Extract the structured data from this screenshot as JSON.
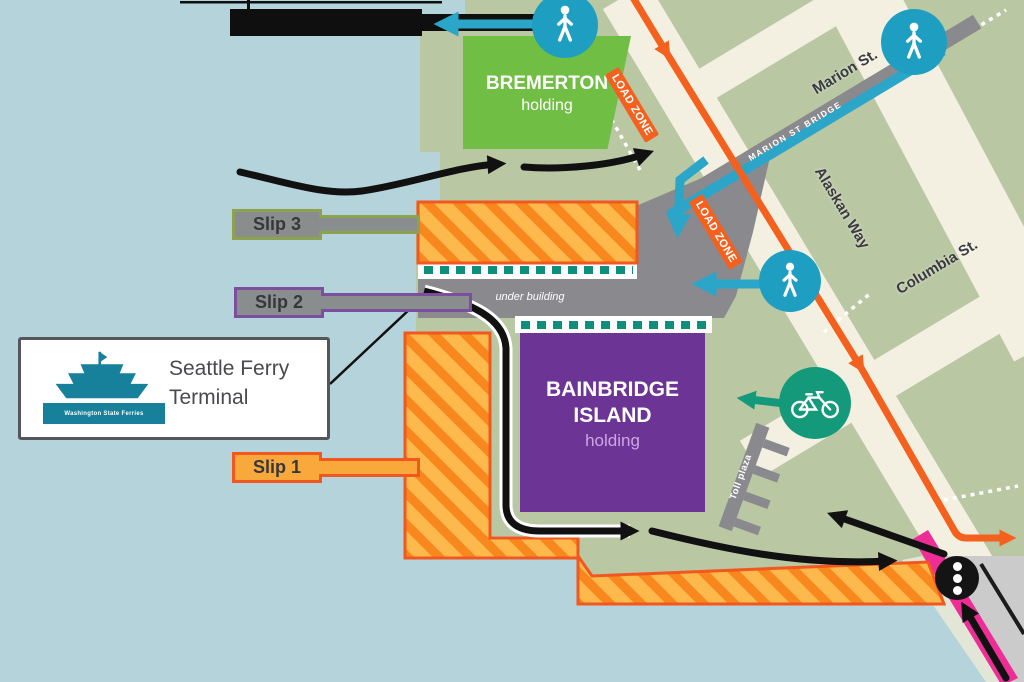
{
  "title": "Seattle Ferry Terminal map",
  "terminal": {
    "callout": {
      "line1": "Seattle Ferry",
      "line2": "Terminal",
      "logo_text": "Washington State Ferries"
    },
    "slips": {
      "slip1": "Slip 1",
      "slip2": "Slip 2",
      "slip3": "Slip 3"
    },
    "under_building": "under building",
    "toll_plaza": "Toll plaza"
  },
  "holding_areas": {
    "bremerton": {
      "name": "BREMERTON",
      "sub": "holding",
      "color": "#70BE44"
    },
    "bainbridge": {
      "name_line1": "BAINBRIDGE",
      "name_line2": "ISLAND",
      "sub": "holding",
      "color": "#6C3494"
    }
  },
  "streets": {
    "marion": "Marion St.",
    "alaskan_way": "Alaskan Way",
    "columbia": "Columbia St.",
    "marion_bridge": "MARION ST BRIDGE"
  },
  "annotations": {
    "load_zone": "LOAD ZONE"
  },
  "legend_colors": {
    "water": "#B5D3DB",
    "land": "#B9C7A3",
    "street": "#F3F0E1",
    "pier_fill": "#FDB94B",
    "pier_stripe": "#F8871E",
    "pier_border": "#F1571F",
    "terminal_gray": "#8A8A8E",
    "vehicle_route": "#111111",
    "pedestrian_route": "#2BA6C9",
    "bike_route": "#149A7B",
    "transit_route": "#F4611E",
    "pink_road": "#EE2D96",
    "teal_dash": "#0E8F7C"
  },
  "icons": {
    "pedestrian": "pedestrian-icon",
    "bicycle": "bicycle-icon",
    "traffic_signal": "traffic-signal-icon",
    "ferry_logo": "washington-state-ferries-logo"
  }
}
